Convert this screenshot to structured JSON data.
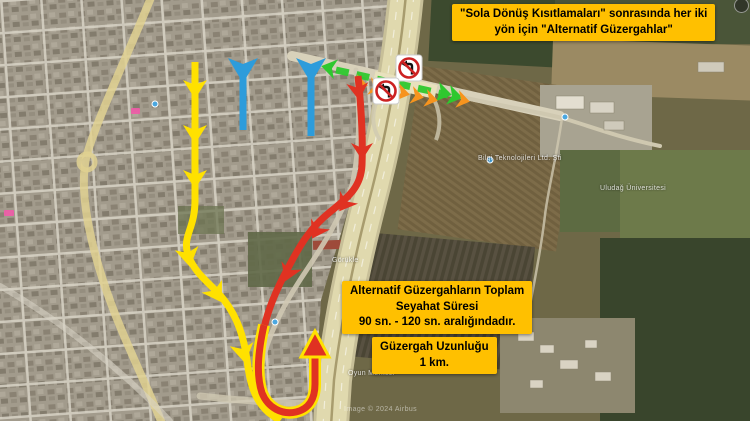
{
  "title_box": {
    "line1": "\"Sola Dönüş Kısıtlamaları\" sonrasında her iki",
    "line2": "yön için \"Alternatif Güzergahlar\""
  },
  "info_boxes": {
    "travel_time": {
      "line1": "Alternatif Güzergahların Toplam",
      "line2": "Seyahat Süresi",
      "line3": "90 sn. - 120 sn. aralığındadır."
    },
    "route_length": {
      "line1": "Güzergah Uzunluğu",
      "line2": "1 km."
    }
  },
  "map": {
    "attribution": "Image © 2024 Airbus",
    "labels": [
      {
        "text": "Görükle"
      },
      {
        "text": "Oyun Merkezi"
      },
      {
        "text": "Bilgi Teknolojileri Ltd. Şti"
      },
      {
        "text": "Uludağ Üniversitesi"
      }
    ]
  },
  "legend_colors": {
    "route_yellow": "#FFE100",
    "route_red": "#E03222",
    "arrow_blue": "#2D9CDB",
    "through_green": "#2EC82E",
    "chevron_orange": "#F7941D",
    "callout_yellow": "#FFC000"
  }
}
